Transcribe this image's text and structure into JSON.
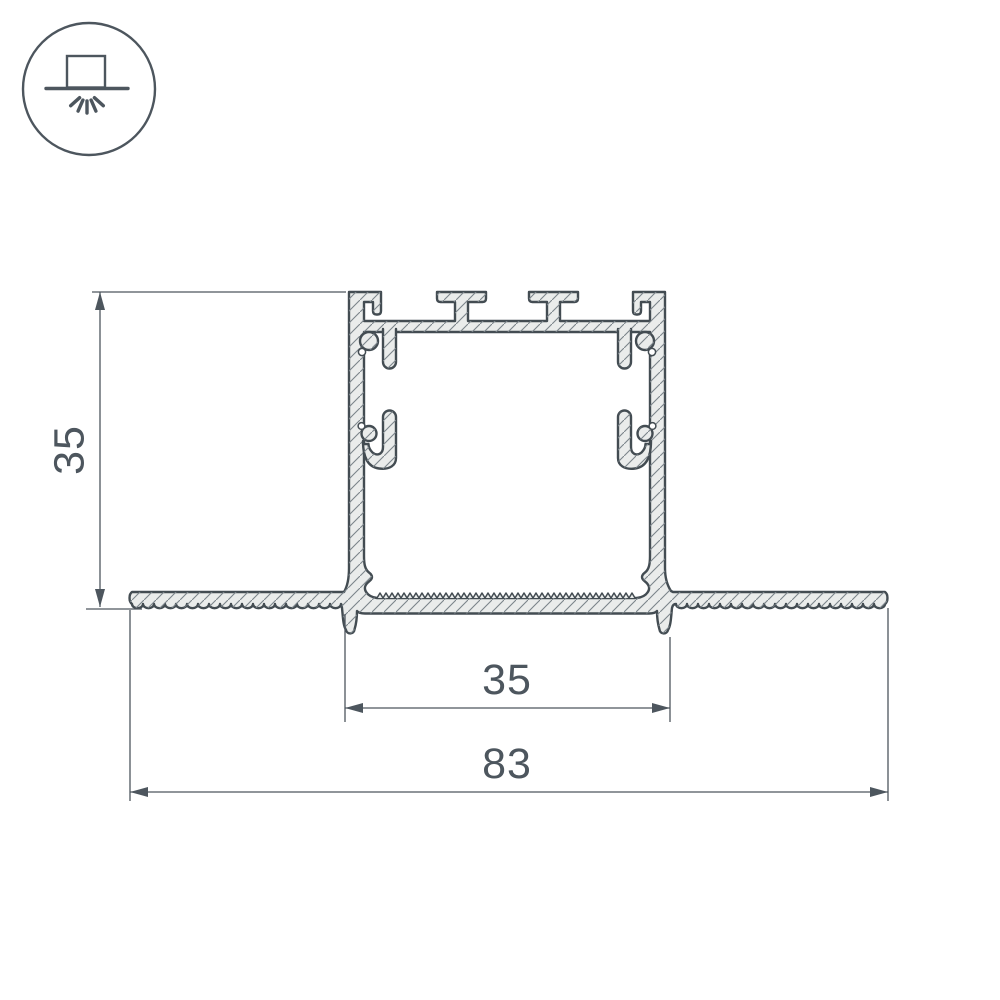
{
  "icon": {
    "name": "recessed-ceiling-light-icon"
  },
  "dimensions": {
    "height_label": "35",
    "inner_width_label": "35",
    "overall_width_label": "83"
  },
  "drawing": {
    "type": "technical-cross-section",
    "subject": "recessed aluminum LED profile with plaster-in flanges"
  },
  "colors": {
    "line": "#434c52",
    "fill": "#eaeceb",
    "dim": "#4d565e",
    "hatch": "#7b848a",
    "background": "#ffffff"
  }
}
